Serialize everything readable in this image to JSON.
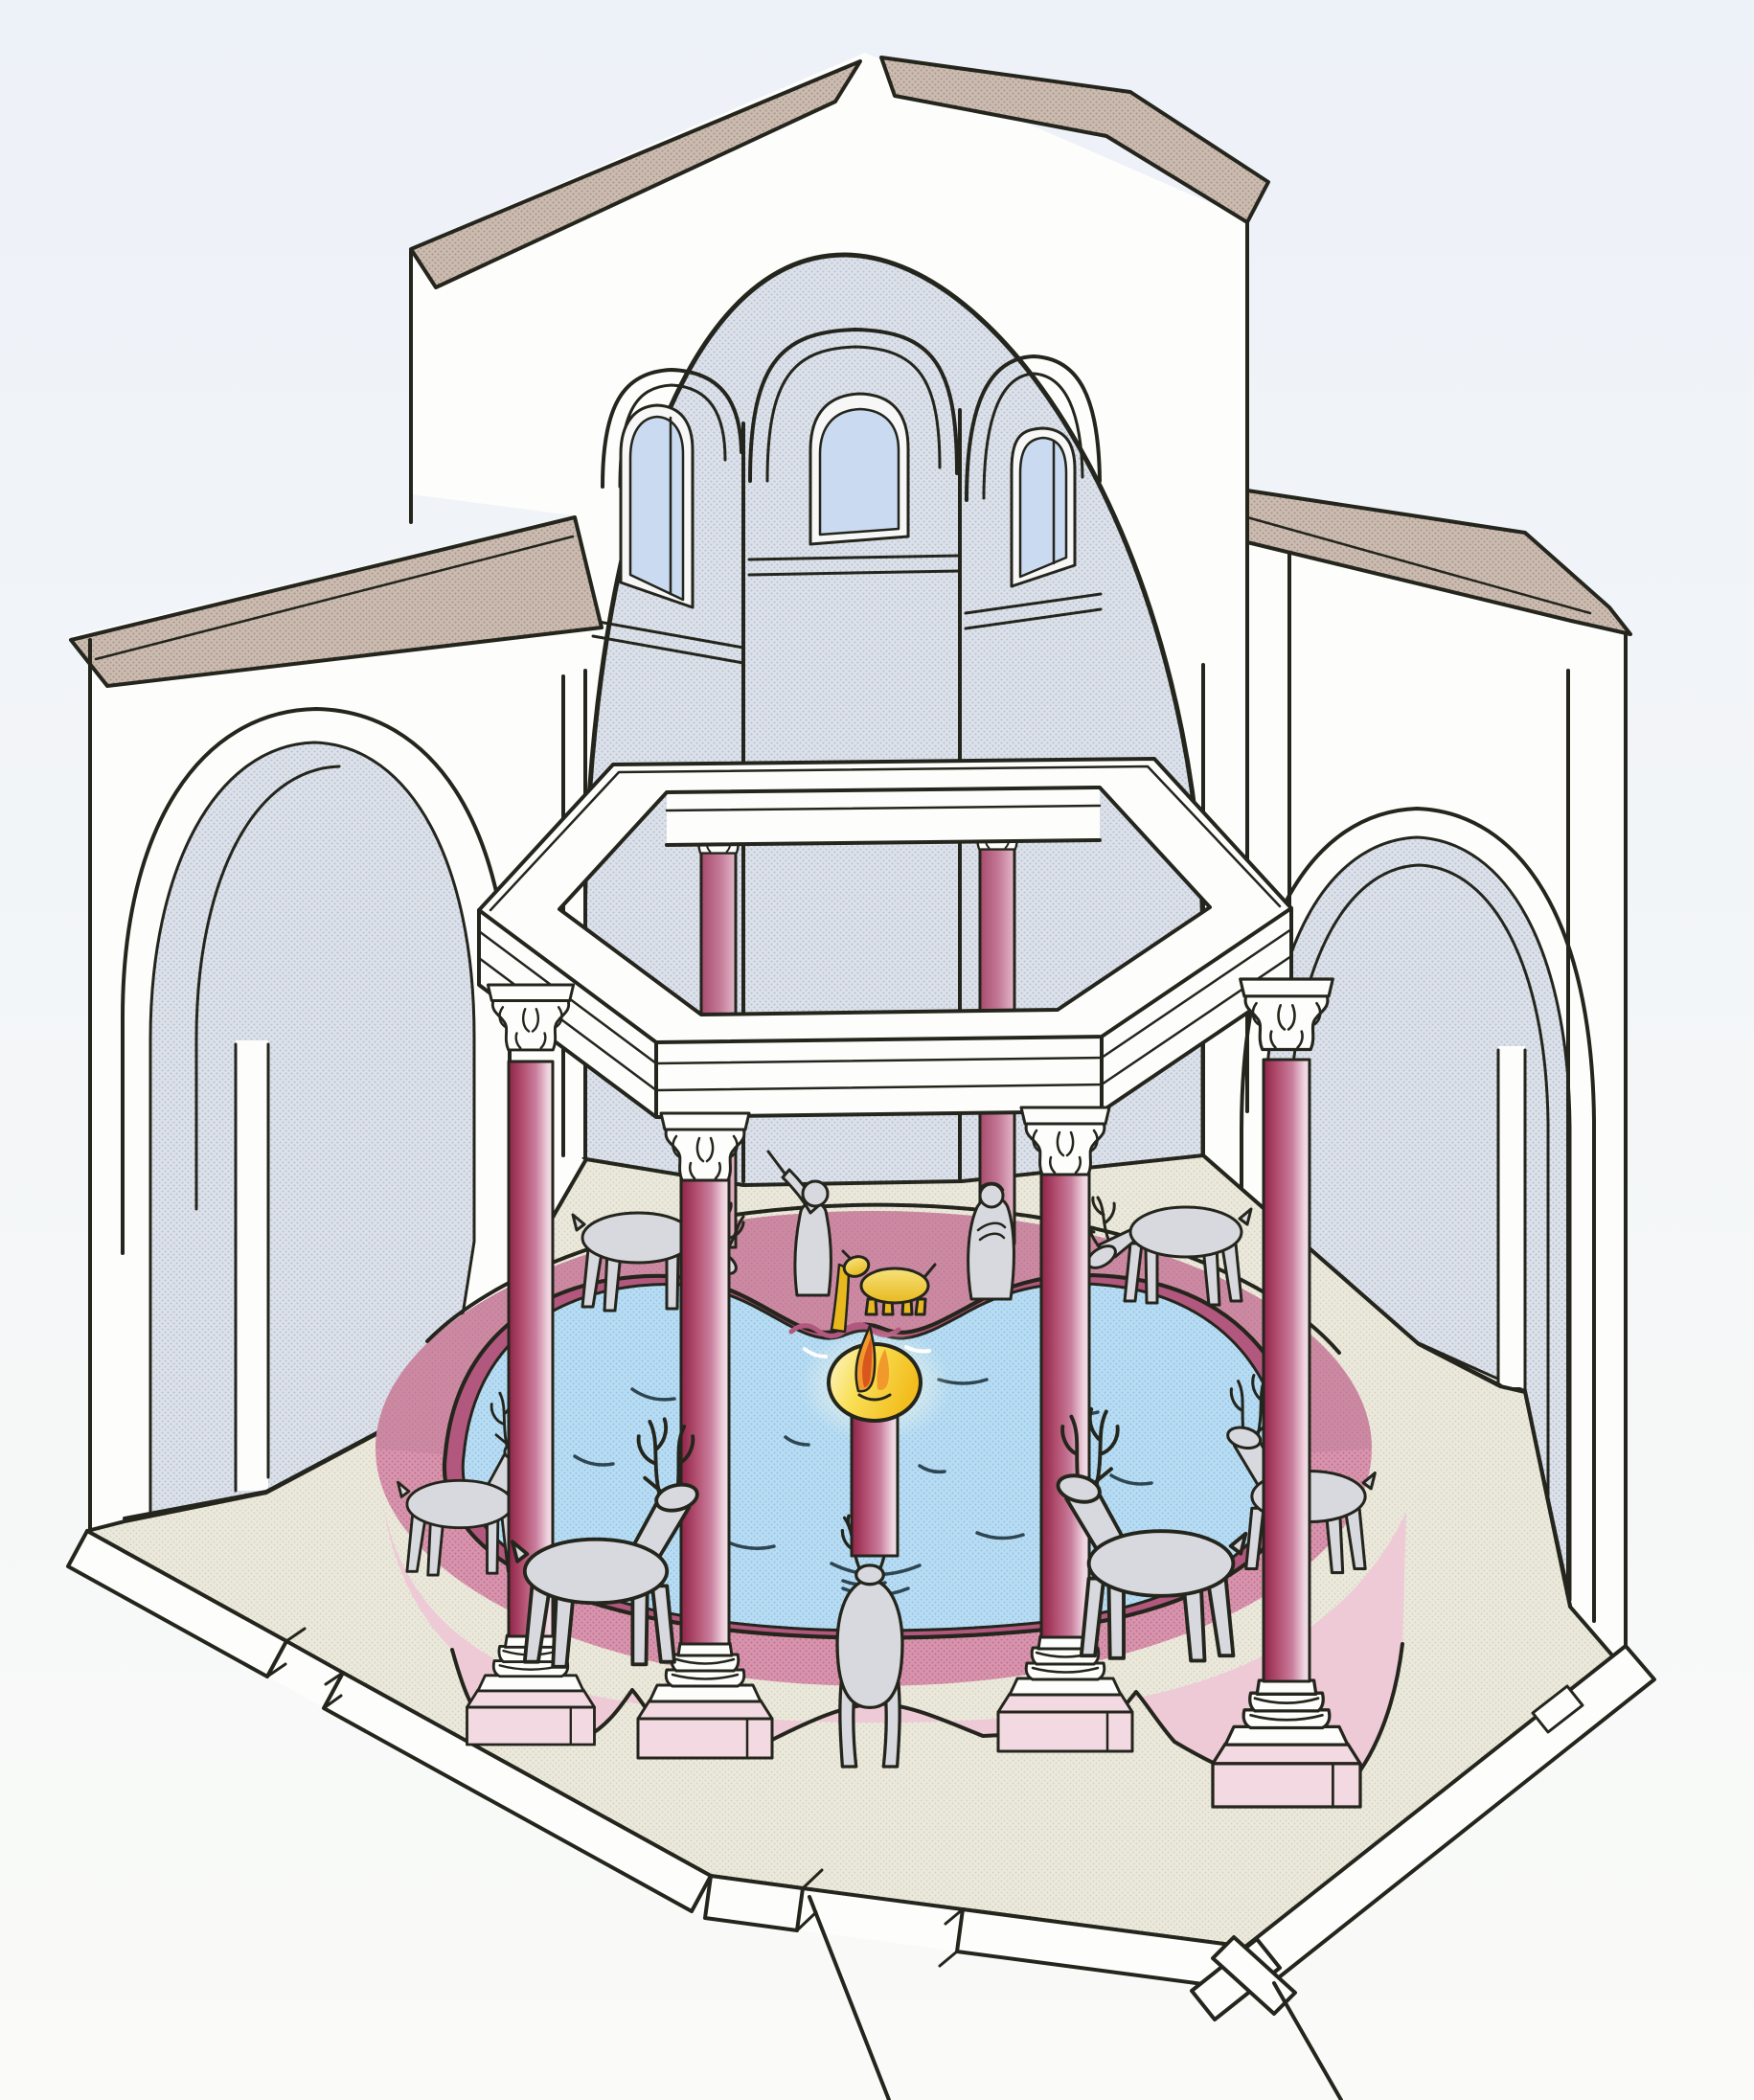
{
  "illustration": {
    "subject": "Octagonal early-Christian baptistery, cutaway reconstruction drawing",
    "view": "axonometric cutaway from the front",
    "parts": {
      "dome": "half-dome over octagonal drum",
      "gable_roof": "pitched roof with two tan slopes",
      "drum_windows_count": 3,
      "side_niches_count": 2,
      "ciborium": "octagonal white entablature ring on porphyry columns",
      "canopy_columns_visible": 6,
      "font": "circular basin with scalloped pink rim",
      "central_lamp": "porphyry shaft with gilded bowl and flame",
      "golden_lamb": 1,
      "figure_statues": 2,
      "deer_statues": 7
    }
  },
  "palette": {
    "page_top": "#edf1f8",
    "page_bottom": "#fafbf8",
    "line": "#24251c",
    "wall_white": "#fdfdfb",
    "interior": "#dde1e9",
    "interior_dot": "#b7c1d3",
    "window_blue": "#c9daf1",
    "window_band": "#f6f7f6",
    "roof_tan": "#cbbbb0",
    "roof_dot": "#a8958a",
    "floor_cream": "#ebe9dc",
    "floor_dot": "#d7d3c0",
    "water": "#b9dcf2",
    "water_dot": "#8ec6e9",
    "ripple": "#2e4552",
    "rim_top": "#d794ac",
    "rim_top_dot": "#c06f92",
    "rim_far_shade": "#c2819b",
    "rim_face": "#eec9d6",
    "rim_lobe": "#f3d9e2",
    "rim_lip": "#b2577d",
    "column_dark": "#8f2449",
    "column_mid": "#b35071",
    "column_rose": "#c97e9d",
    "column_light": "#edd2dd",
    "column_edge": "#f3e3ea",
    "back_column_dark": "#a84a6c",
    "back_column_mid": "#c47b98",
    "back_column_light": "#e3b8c9",
    "gold_pale": "#fdf6d0",
    "gold": "#f9df56",
    "gold_deep": "#f2bd1d",
    "flame_orange": "#f2992b",
    "flame_deep": "#d8571e",
    "lamb_light": "#f6e27a",
    "lamb_gold": "#e8b91f",
    "statue_grey": "#d8d9de",
    "glow": "#fff9e0"
  }
}
